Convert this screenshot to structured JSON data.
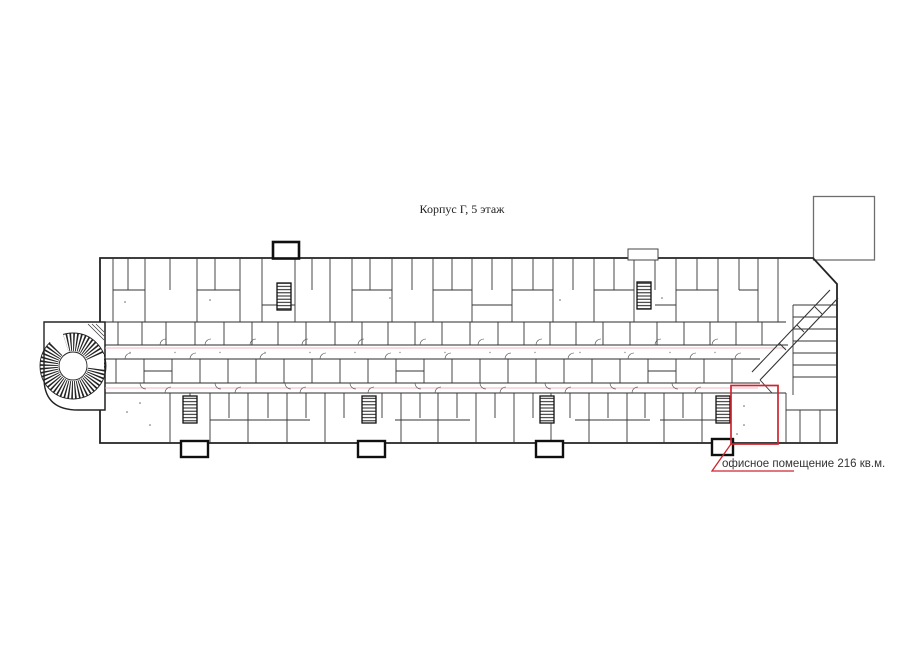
{
  "title": {
    "text": "Корпус Г, 5 этаж"
  },
  "highlight_room": {
    "label": "офисное помещение 216 кв.м.",
    "area_sqm": 216
  },
  "colors": {
    "highlight": "#cf2430",
    "corridor_line": "#edacb9",
    "walls": "#2e2e2e",
    "annex_outline": "#6e6e6e"
  }
}
